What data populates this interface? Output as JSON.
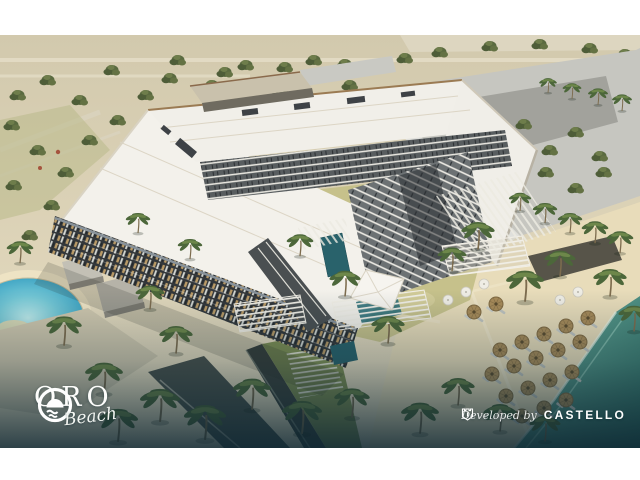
{
  "brand": {
    "name": "ORO",
    "tagline": "Beach"
  },
  "credit": {
    "prefix": "Developed by",
    "company": "CASTELLO"
  },
  "icons": {
    "brand": "sun-over-waves-icon",
    "developer": "castle-icon"
  },
  "colors": {
    "frame_white": "#ffffff",
    "desert_sand": "#d5ccb2",
    "beach_sand": "#e8dcba",
    "roof_white": "#f2f0ea",
    "facade_dark": "#34383a",
    "sea_teal": "#3d8276",
    "lagoon_turquoise": "#3ba5c6",
    "palm_green": "#4c673a",
    "lawn_yellow_green": "#c6c18b",
    "overlay_teal": "#0e2935",
    "logo_white": "#fdfdfb"
  }
}
